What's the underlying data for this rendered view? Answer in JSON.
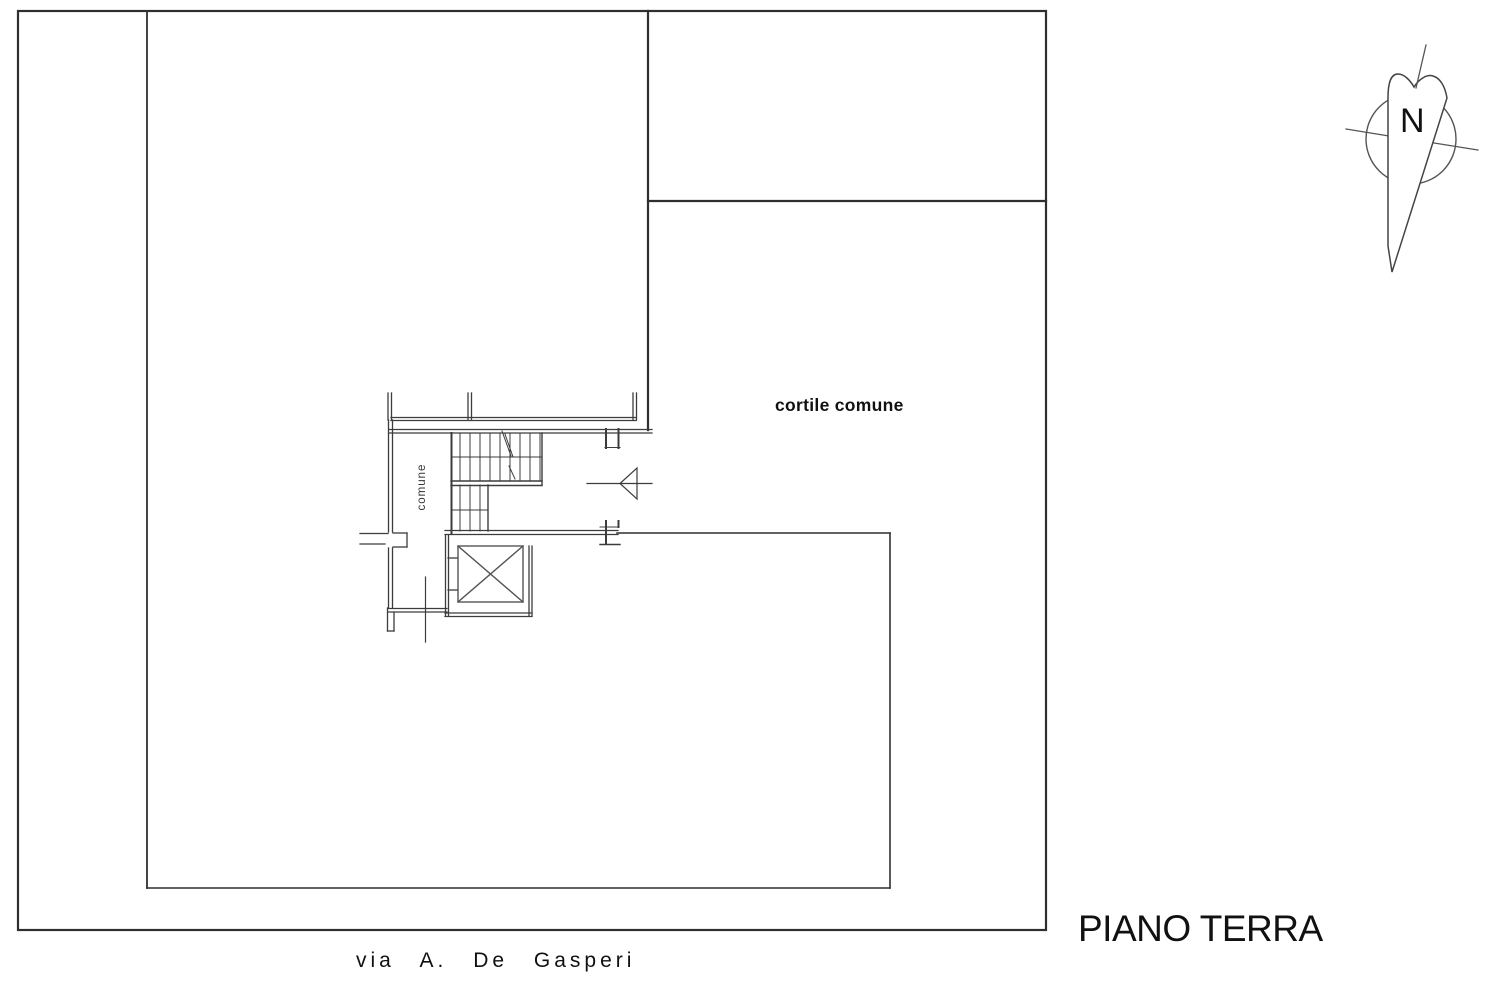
{
  "title": "PIANO TERRA",
  "labels": {
    "floor_title": "PIANO TERRA",
    "courtyard": "cortile comune",
    "stair_corridor": "comune",
    "street": "via  A.  De  Gasperi",
    "compass_north": "N"
  },
  "colors": {
    "background": "#ffffff",
    "parcel_line": "#2f2f2f",
    "wall_line": "#3c3c3c",
    "detail_line": "#555555",
    "text": "#111111"
  }
}
